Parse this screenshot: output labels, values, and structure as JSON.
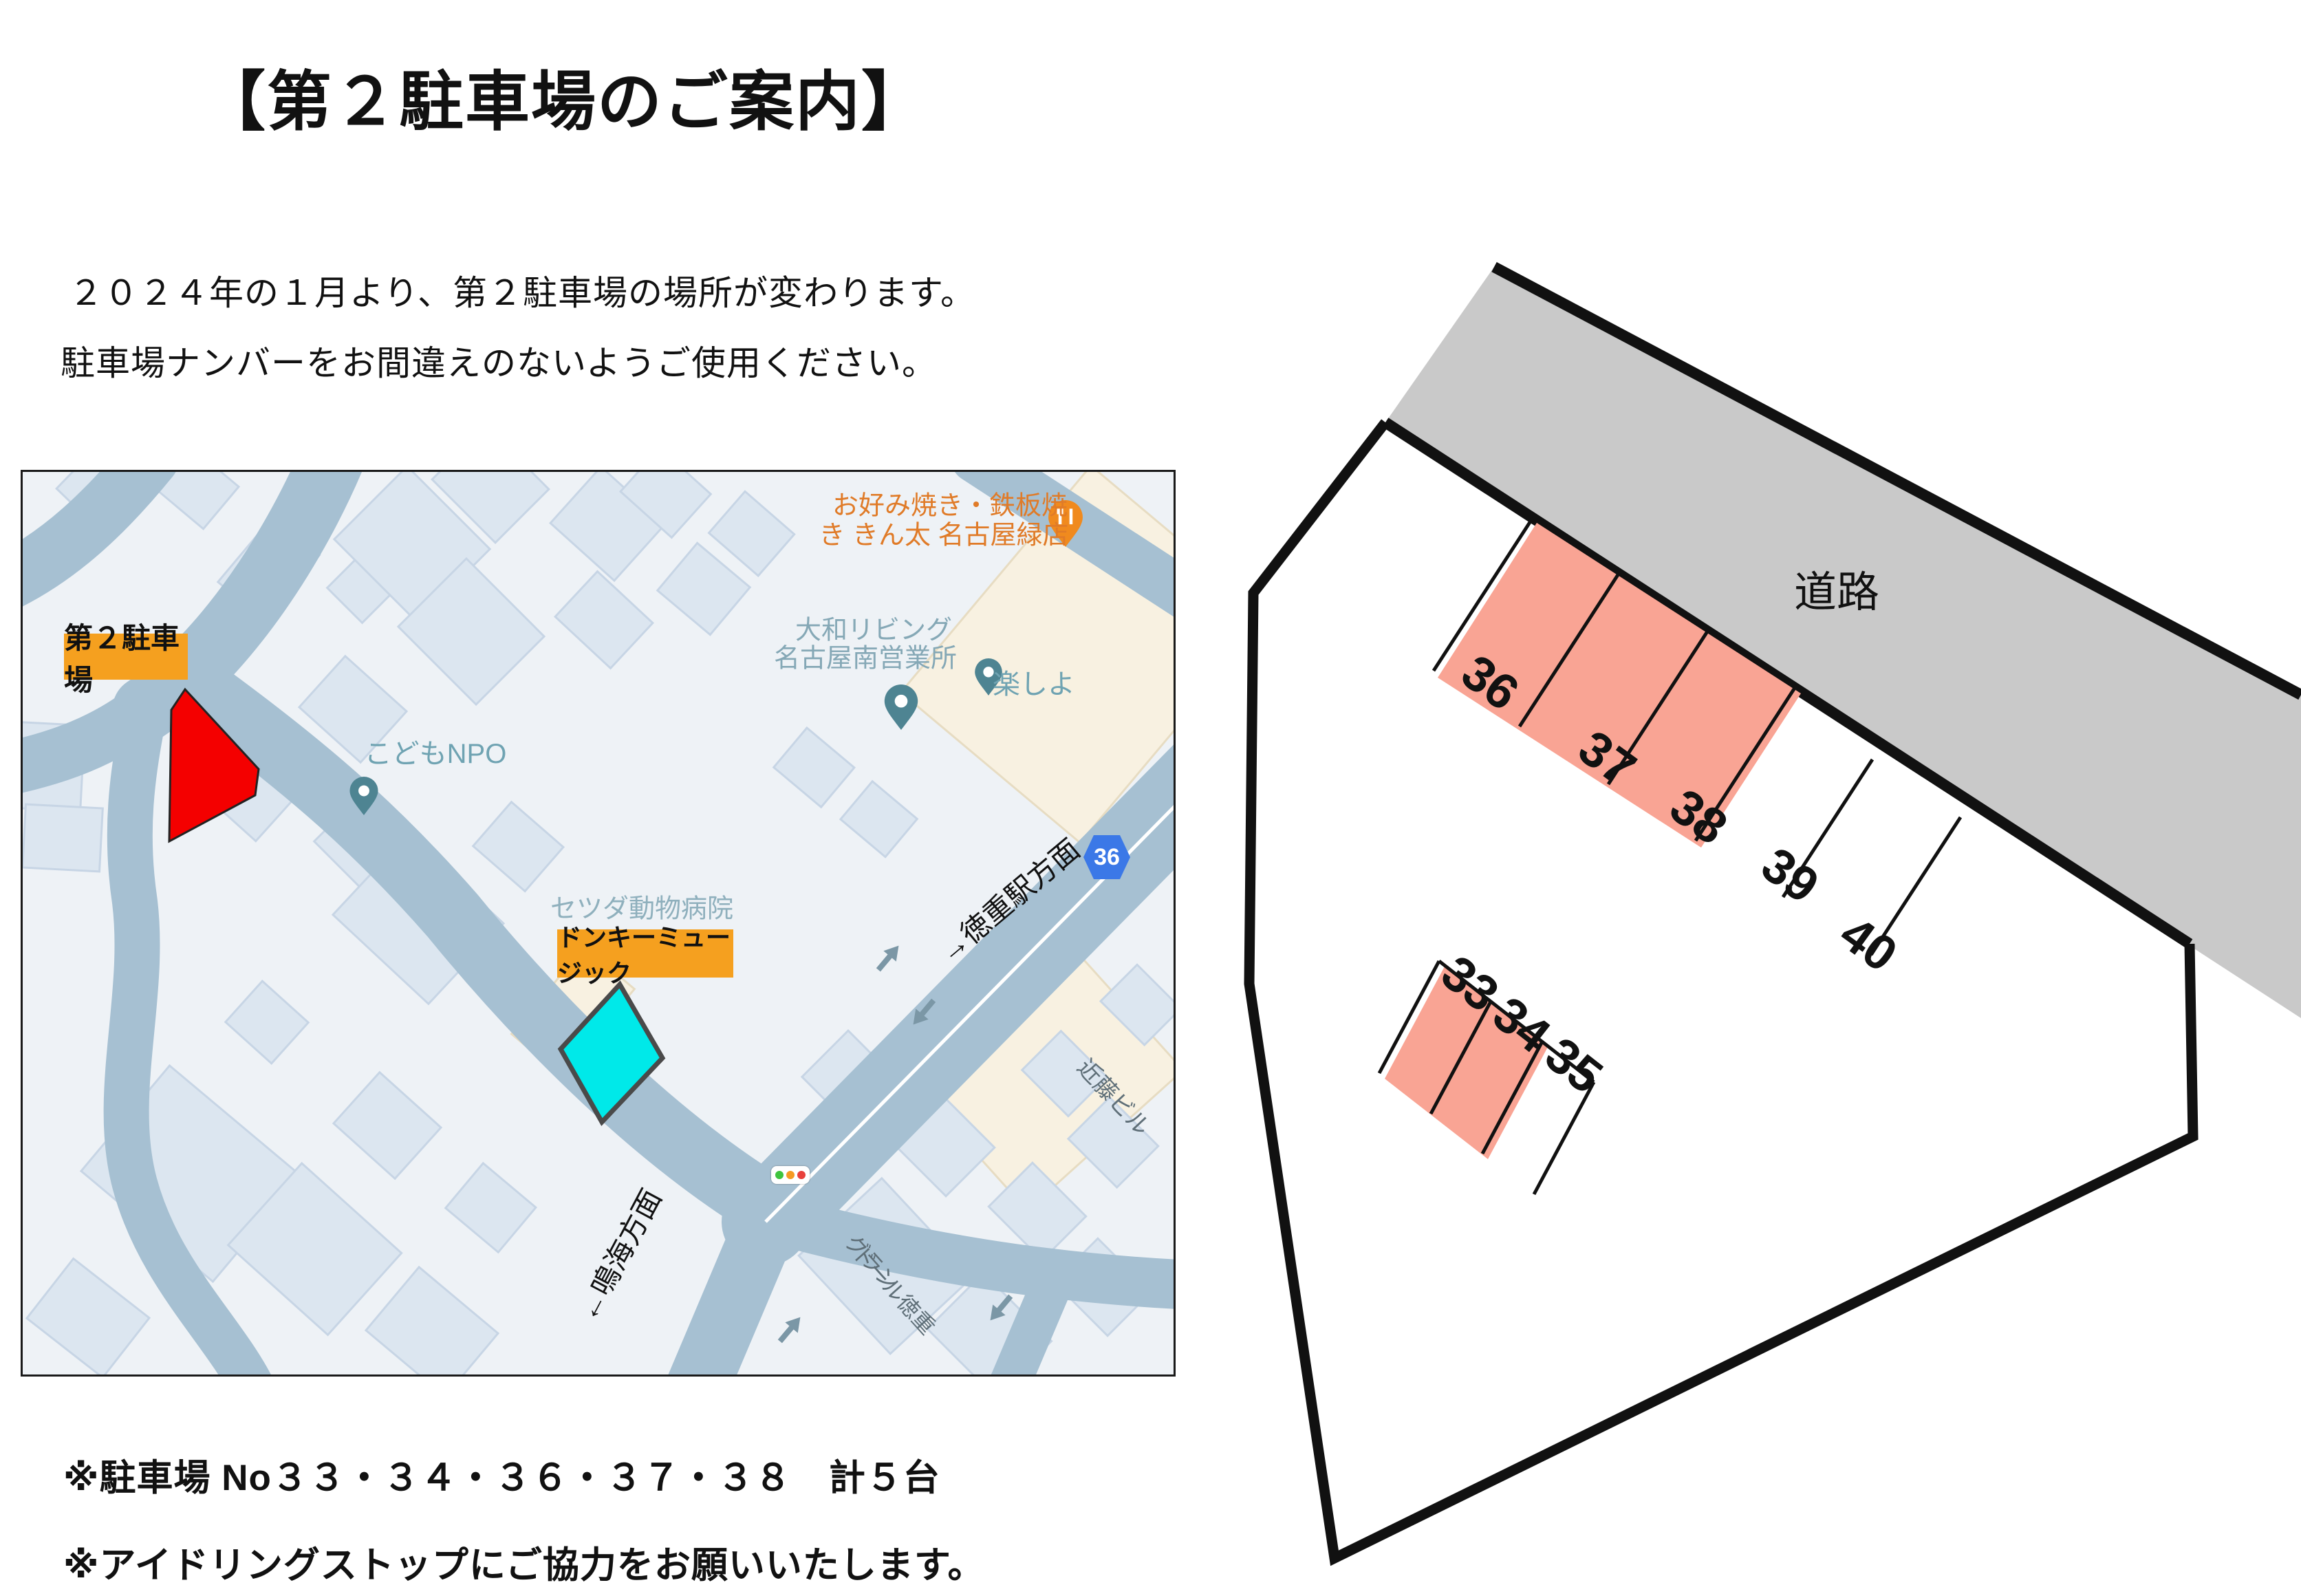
{
  "header": {
    "title": "【第２駐車場のご案内】"
  },
  "intro": {
    "line1": "２０２４年の１月より、第２駐車場の場所が変わります。",
    "line2": "駐車場ナンバーをお間違えのないようご使用ください。"
  },
  "notes": {
    "line1": "※駐車場 No３３・３４・３６・３７・３８　計５台",
    "line2": "※アイドリングストップにご協力をお願いいたします。"
  },
  "map": {
    "labels": {
      "parking_box": "第２駐車場",
      "donkey_box": "ドンキーミュージック",
      "kodomo_npo": "こどもNPO",
      "setsuda": "セツダ動物病院",
      "yamato_line1": "大和リビング",
      "yamato_line2": "名古屋南営業所",
      "kinta_line1": "お好み焼き・鉄板焼",
      "kinta_line2": "き きん太 名古屋緑店",
      "tanoshiyo": "楽しよ",
      "route_badge": "36",
      "tokushige_direction": "→徳重駅方面",
      "narumi_direction": "←鳴海方面",
      "kondo": "近藤ビル",
      "grandole_line1": "グラン",
      "grandole_line2": "ドール徳重"
    },
    "colors": {
      "road": "#a6c0d2",
      "building": "#dce6f0",
      "beige": "#f8f1e1",
      "target_red": "#f40000",
      "donkey_cyan": "#00e9e9",
      "label_orange": "#f5a01f",
      "badge_blue": "#3b78e7"
    }
  },
  "diagram": {
    "road_label": "道路",
    "upper_stalls": [
      "36",
      "37",
      "38",
      "39",
      "40"
    ],
    "lower_stalls": [
      "33",
      "34",
      "35"
    ],
    "colors": {
      "stall_fill": "#f9a494",
      "road_gray": "#c9c9c9",
      "outline": "#111111"
    }
  }
}
